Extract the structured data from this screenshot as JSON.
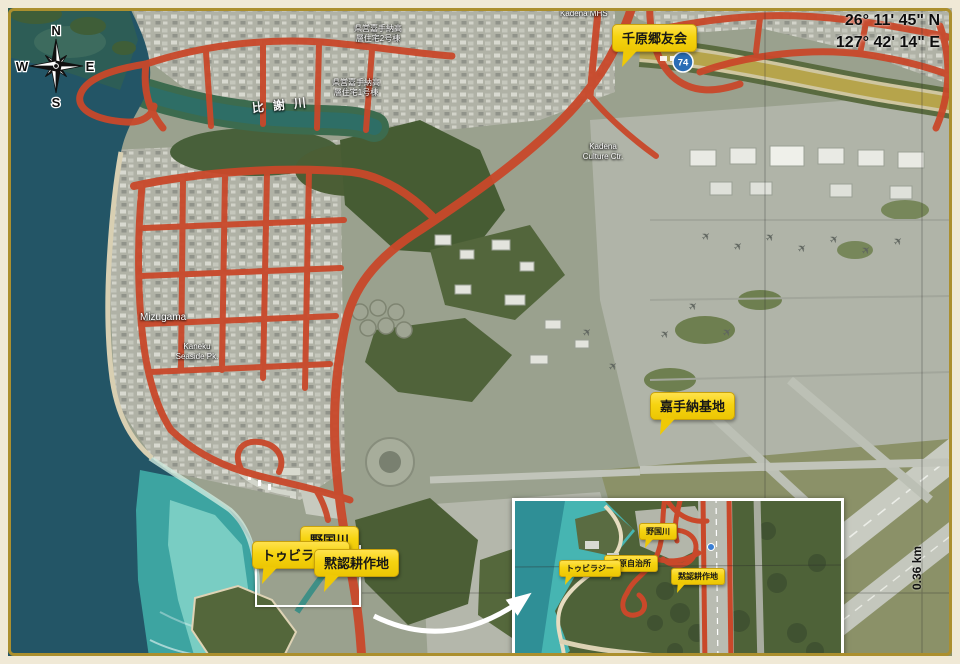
{
  "window": {
    "width": 960,
    "height": 664,
    "description": "Aerial map of Kadena area, Okinawa, with walking-route overlay and annotation pins"
  },
  "coordinates": {
    "lat": "26° 11' 45\" N",
    "lon": "127° 42' 14\" E"
  },
  "compass": {
    "north": "N",
    "west": "W",
    "east": "E",
    "south": "S"
  },
  "scale_label": "0.36 km",
  "route_shield": {
    "number": "74"
  },
  "pins": {
    "chihara_gouyuukai": "千原郷友会",
    "kadena_kichi": "嘉手納基地",
    "nogunigawa": "野国川",
    "tubiraji": "トゥビラジー",
    "mokunin_kousakuchi": "黙認耕作地"
  },
  "inset_pins": {
    "nogunigawa": "野国川",
    "chihara_jichisho": "千原自治所",
    "tubiraji": "トゥビラジー",
    "mokunin_kousakuchi": "黙認耕作地"
  },
  "map_labels": {
    "hijagawa": "比謝川",
    "kenei_jutaku_2gou": "県営嘉手納高層住宅2号棟",
    "kenei_jutaku_1gou": "県営嘉手納高層住宅1号棟",
    "mizugama": "Mizugama",
    "kaneku_park": "Kaneku Seaside Pk.",
    "kadena_culture_ctr": "Kadena Culture Ctr.",
    "kadena_mhs": "Kadena MHS"
  },
  "icons": {
    "aircraft": "✈"
  },
  "colors": {
    "frame_cream": "#f0e9d6",
    "frame_gold": "#ab8f2e",
    "route_red": "#c9482a",
    "pin_yellow": "#f6d411",
    "shield_blue": "#2a6db5",
    "ocean_deep": "#235566",
    "ocean_shallow": "#3fa9a4",
    "inset_border": "#ffffff"
  }
}
